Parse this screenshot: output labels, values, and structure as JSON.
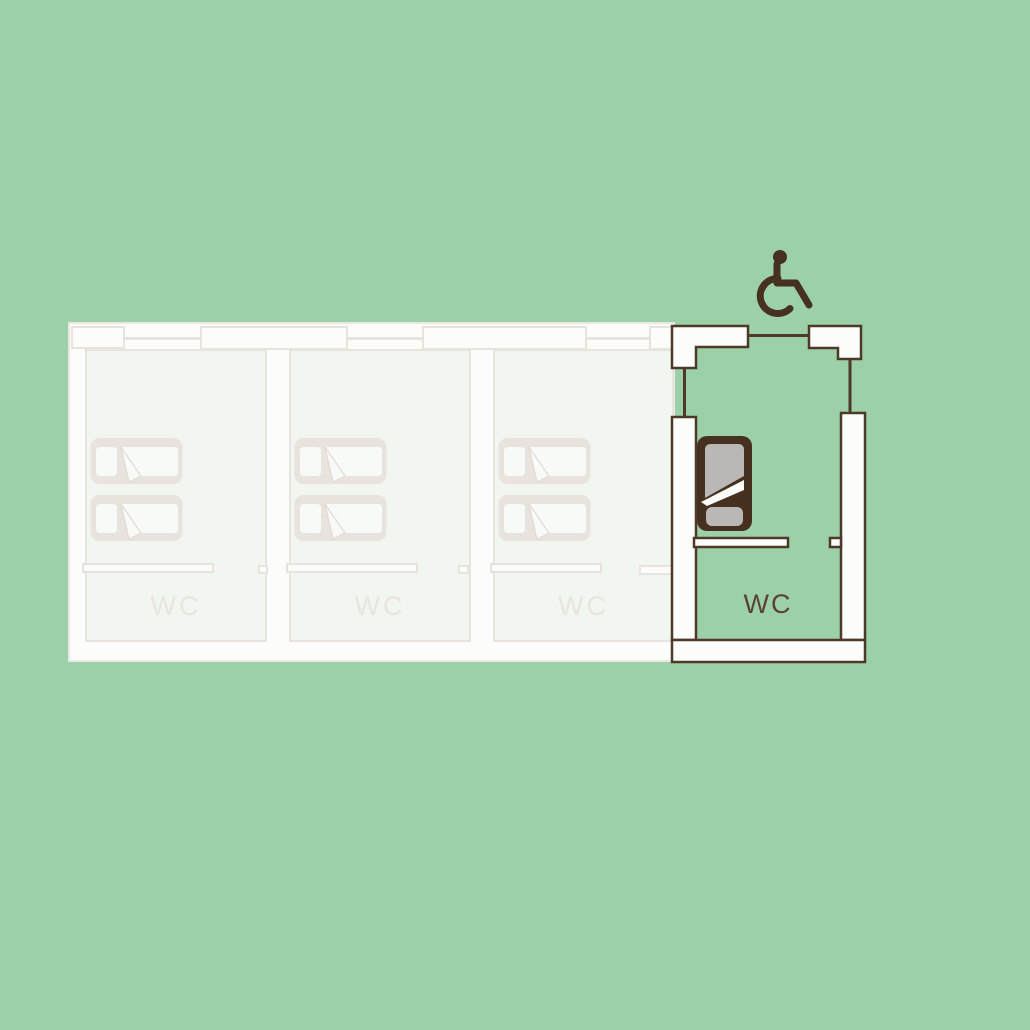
{
  "palette": {
    "background": "#9cd0a8",
    "outline_brown": "#4e3827",
    "dark_brown": "#46301f",
    "text_brown": "#5a4330",
    "faded_white": "#fcfdfb",
    "faded_room_fill": "#f1f6f0",
    "faded_outline": "#e9e3de",
    "faded_text": "#eae4df",
    "mattress_gray": "#b9b8b6"
  },
  "floor_plan": {
    "faded_rooms": [
      {
        "id": "room-1",
        "wc_label": "WC"
      },
      {
        "id": "room-2",
        "wc_label": "WC"
      },
      {
        "id": "room-3",
        "wc_label": "WC"
      }
    ],
    "accessible_room": {
      "wc_label": "WC",
      "icon": "wheelchair-icon"
    }
  }
}
